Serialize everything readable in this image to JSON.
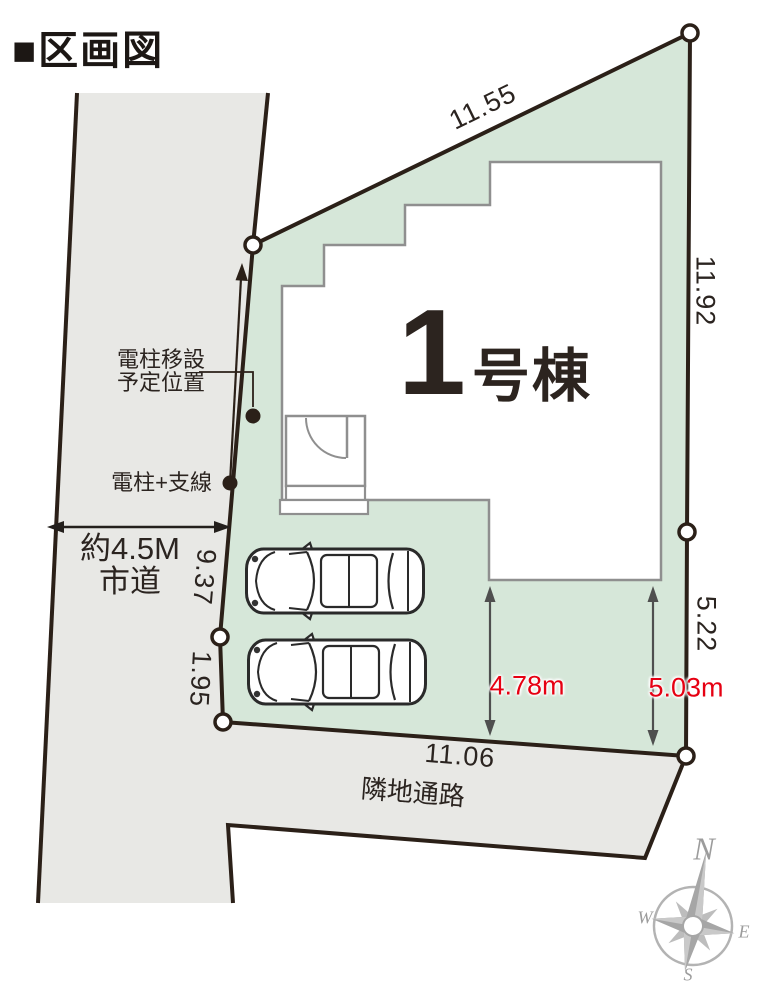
{
  "title": "■区画図",
  "building": {
    "number": "1",
    "suffix": "号棟"
  },
  "boundary_dims": {
    "top": "11.55",
    "right_upper": "11.92",
    "right_lower": "5.22",
    "left_upper": "9.37",
    "left_lower": "1.95",
    "bottom": "11.06"
  },
  "setback_dims": {
    "left": "4.78m",
    "right": "5.03m"
  },
  "road": {
    "line1": "約4.5M",
    "line2": "市道"
  },
  "pole": {
    "relocation_line1": "電柱移設",
    "relocation_line2": "予定位置",
    "existing": "電柱+支線"
  },
  "passage": "隣地通路",
  "compass": {
    "north": "N",
    "east": "E",
    "south": "S",
    "west": "W"
  },
  "colors": {
    "plot_fill": "#d6e7d9",
    "road_fill": "#e8e8e5",
    "boundary_stroke": "#2b2018",
    "house_stroke": "#8f8f8f",
    "dimension_red": "#e60012",
    "dimension_arrow_gray": "#4f4f4f",
    "compass_gray": "#a6a6a6",
    "text_dark": "#2b2420"
  }
}
